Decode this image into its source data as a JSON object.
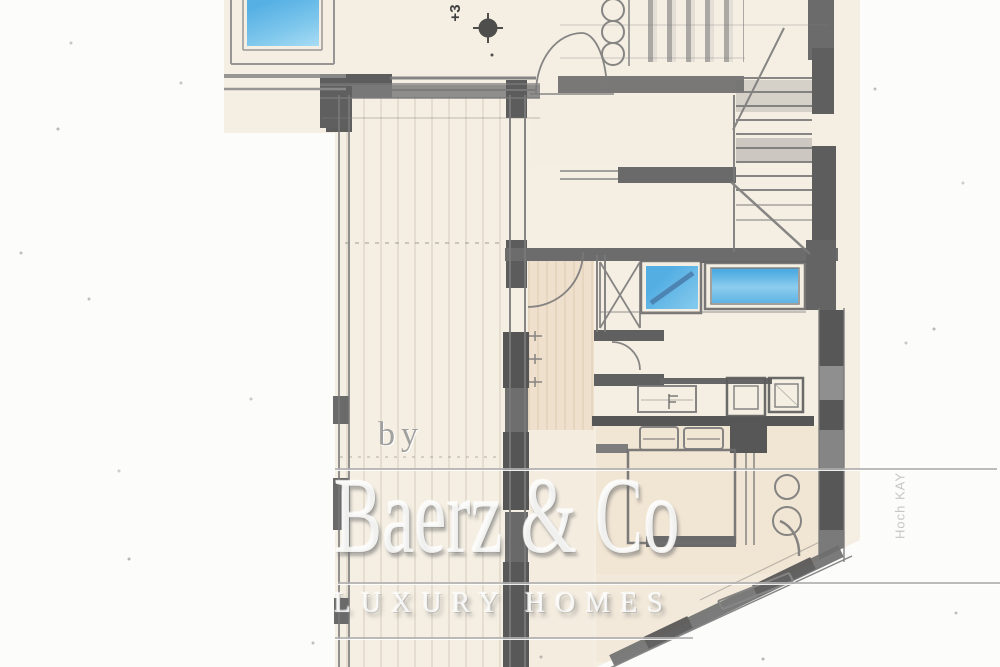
{
  "document": {
    "kind": "Hand-drawn architectural floor plan sketch (scanned pencil drawing)",
    "floor_label_rotated": "+3",
    "margin_note_rotated": "Hoch KAY"
  },
  "watermark": {
    "by_label": "by",
    "brand": "Baerz & Co",
    "tagline": "LUXURY HOMES"
  },
  "features": [
    "pool-window",
    "terrace-decking",
    "double-door",
    "staircase",
    "hallway",
    "blue-windows",
    "closet-row",
    "double-bed",
    "angled-facade-wall"
  ],
  "icons": {
    "survey_marker": "survey-marker-icon"
  },
  "colors": {
    "scan_background": "#fcfcfb",
    "paper": "#f5efe3",
    "pencil": "#6f6f6f",
    "pencil_dark": "#565656",
    "window_blue": "#4fabe0",
    "window_blue_light": "#8ccdee",
    "floor_tan": "#ecd9c2",
    "watermark_gray": "#b9b9b9"
  }
}
